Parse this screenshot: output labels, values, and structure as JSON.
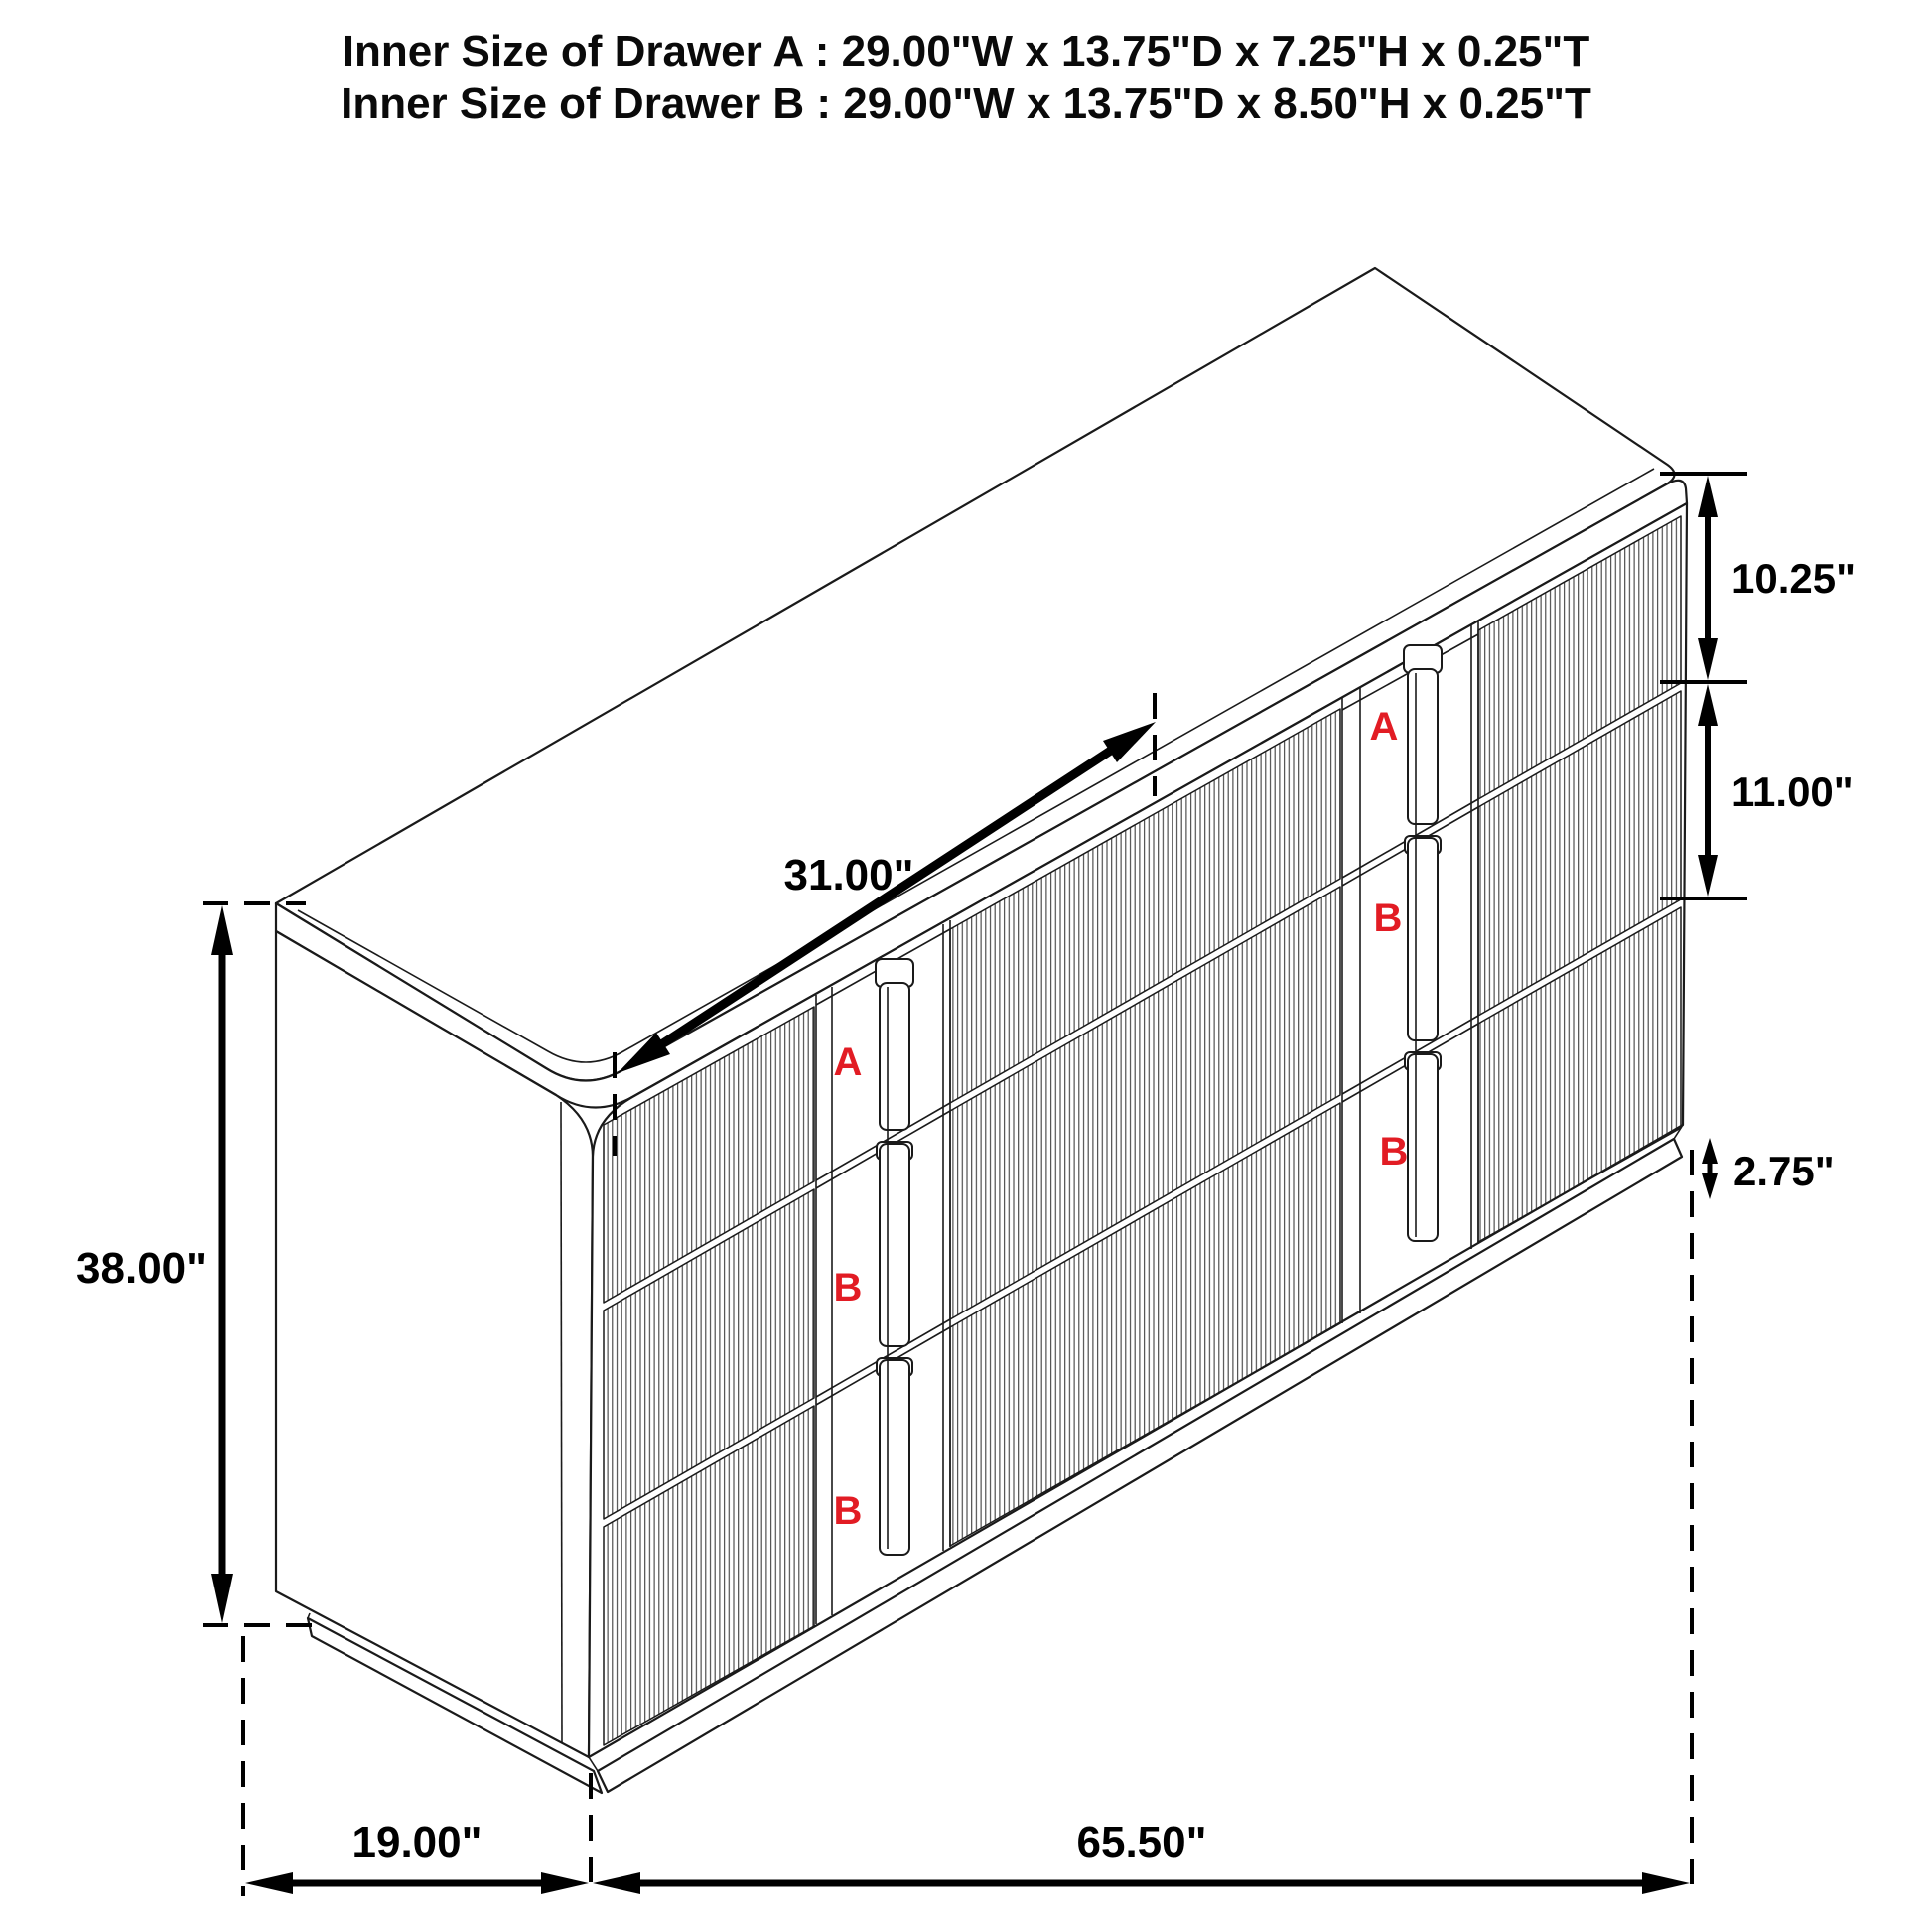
{
  "title": {
    "line1": "Inner Size of Drawer A : 29.00\"W x 13.75\"D x 7.25\"H x 0.25\"T",
    "line2": "Inner Size of Drawer B : 29.00\"W x 13.75\"D x 8.50\"H x 0.25\"T"
  },
  "dimensions": {
    "drawer_opening_width": "31.00\"",
    "total_height": "38.00\"",
    "depth": "19.00\"",
    "total_width": "65.50\"",
    "top_drawer_height": "10.25\"",
    "middle_drawer_height": "11.00\"",
    "base_height": "2.75\""
  },
  "drawer_labels": {
    "left_bank": [
      "A",
      "B",
      "B"
    ],
    "right_bank": [
      "A",
      "B",
      "B"
    ]
  },
  "colors": {
    "line": "#1a1a1a",
    "dimension": "#000000",
    "label_red": "#e21c24",
    "background": "#ffffff"
  }
}
